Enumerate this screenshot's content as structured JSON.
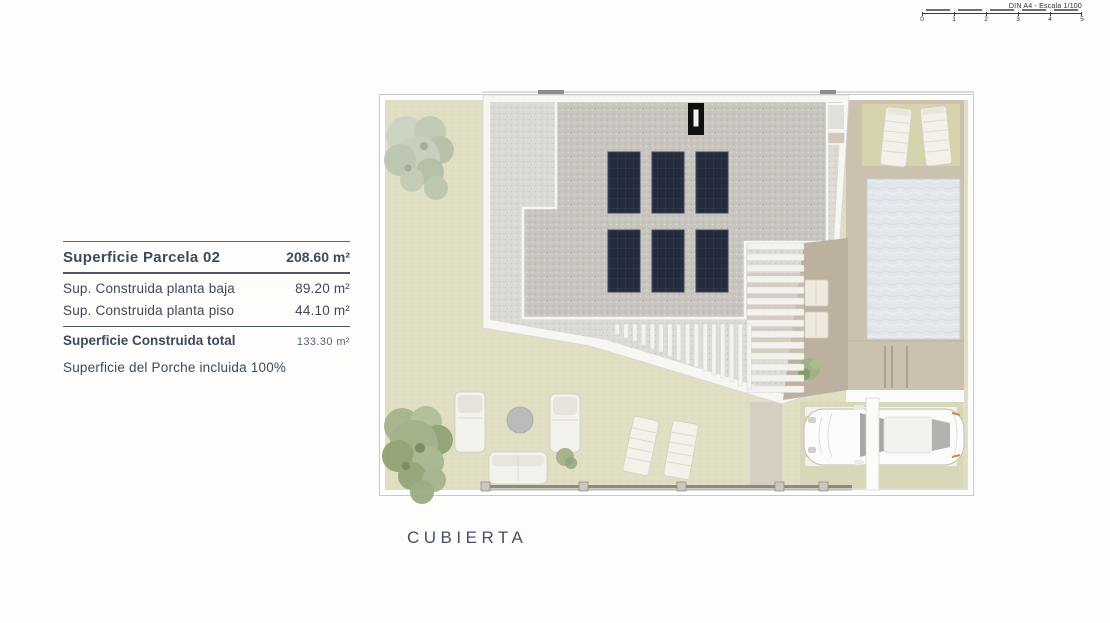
{
  "scale_bar": {
    "label": "DIN A4 - Escala 1/100",
    "ticks": [
      "0",
      "1",
      "2",
      "3",
      "4",
      "5"
    ]
  },
  "info_panel": {
    "title": {
      "label": "Superficie Parcela 02",
      "value": "208.60 m²"
    },
    "rows": [
      {
        "label": "Sup. Construida planta baja",
        "value": "89.20 m²"
      },
      {
        "label": "Sup. Construida planta piso",
        "value": "44.10 m²"
      }
    ],
    "total": {
      "label": "Superficie Construida total",
      "value": "133.30 m²"
    },
    "note": "Superficie del Porche incluida 100%"
  },
  "plan": {
    "caption": "CUBIERTA",
    "colors": {
      "lawn": "#e0dfc3",
      "roof_gravel_light": "#dcdad4",
      "roof_gravel_dark": "#c9c6c0",
      "solar_panel": "#242b3c",
      "pool_water": "#e2e7eb",
      "deck_tan": "#cbc1af",
      "terrace_tan": "#b5aa98",
      "wall_gray": "#8d8a84",
      "text_accent": "#3e4a5a"
    },
    "features": {
      "solar_panels_count": 6,
      "elements": [
        "gravel flat roof",
        "solar panels",
        "chimney",
        "swimming pool",
        "sun loungers",
        "slatted pergola",
        "stairs",
        "garden sofas and round table",
        "car on driveway",
        "trees"
      ]
    }
  }
}
